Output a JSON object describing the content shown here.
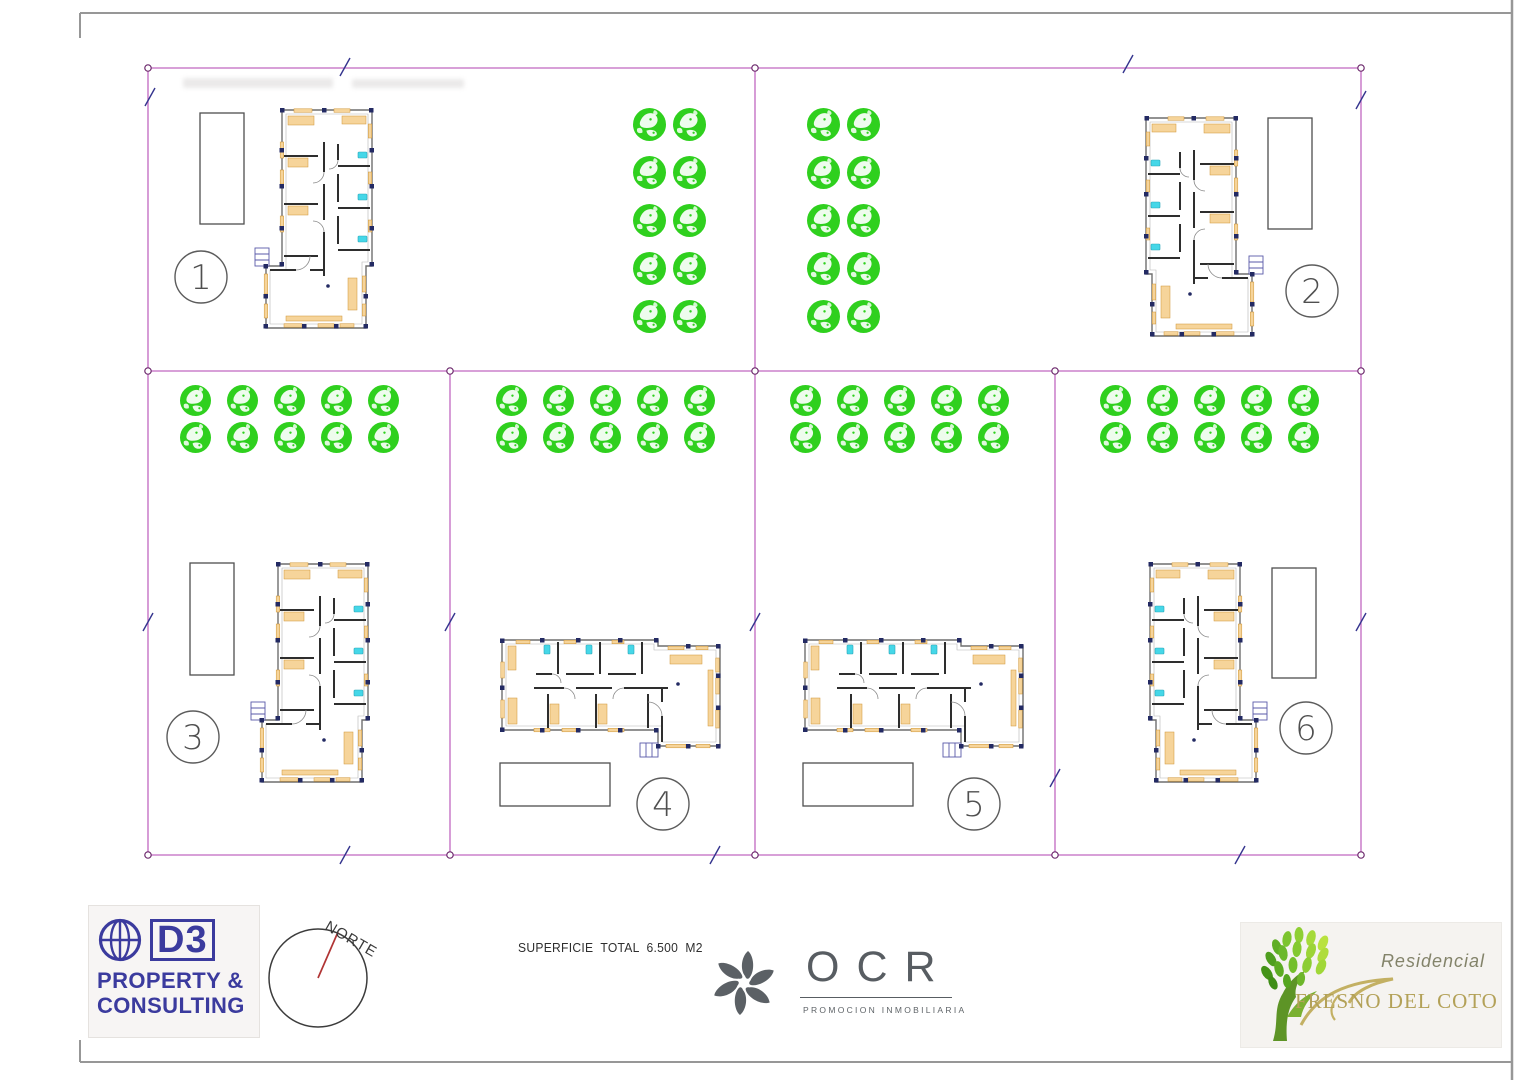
{
  "site": {
    "colors": {
      "boundary": "#c168c1",
      "tick": "#34348e",
      "marker": "#6d2a6d",
      "tree": "#2fd01e"
    },
    "boundary_lines": [
      [
        148,
        68,
        1361,
        68
      ],
      [
        1361,
        68,
        1361,
        855
      ],
      [
        148,
        855,
        1361,
        855
      ],
      [
        148,
        68,
        148,
        855
      ],
      [
        755,
        68,
        755,
        371
      ],
      [
        148,
        371,
        1361,
        371
      ],
      [
        450,
        371,
        450,
        855
      ],
      [
        755,
        371,
        755,
        855
      ],
      [
        1055,
        371,
        1055,
        855
      ]
    ],
    "ticks": [
      [
        345,
        67
      ],
      [
        1128,
        64
      ],
      [
        150,
        97
      ],
      [
        1361,
        100
      ],
      [
        148,
        622
      ],
      [
        450,
        622
      ],
      [
        755,
        622
      ],
      [
        1361,
        622
      ],
      [
        345,
        855
      ],
      [
        715,
        855
      ],
      [
        1240,
        855
      ],
      [
        1055,
        778
      ]
    ],
    "markers": [
      [
        148,
        68
      ],
      [
        755,
        68
      ],
      [
        1361,
        68
      ],
      [
        148,
        371
      ],
      [
        450,
        371
      ],
      [
        755,
        371
      ],
      [
        1055,
        371
      ],
      [
        1361,
        371
      ],
      [
        148,
        855
      ],
      [
        450,
        855
      ],
      [
        755,
        855
      ],
      [
        1055,
        855
      ],
      [
        1361,
        855
      ]
    ],
    "plots": [
      {
        "number": "1",
        "circle": [
          201,
          277,
          26
        ],
        "pool": [
          200,
          113,
          44,
          111
        ],
        "house": "translate(262,108)",
        "trees": {
          "x": 633,
          "y": 108,
          "cols": 2,
          "rows": 5,
          "px": 40,
          "py": 48,
          "d": 33
        }
      },
      {
        "number": "2",
        "circle": [
          1312,
          291,
          26
        ],
        "pool": [
          1268,
          118,
          44,
          111
        ],
        "house": "translate(1256,116) scale(-1,1)",
        "trees": {
          "x": 807,
          "y": 108,
          "cols": 2,
          "rows": 5,
          "px": 40,
          "py": 48,
          "d": 33
        }
      },
      {
        "number": "3",
        "circle": [
          193,
          737,
          26
        ],
        "pool": [
          190,
          563,
          44,
          112
        ],
        "house": "translate(258,562)",
        "trees": {
          "x": 180,
          "y": 385,
          "cols": 5,
          "rows": 2,
          "px": 47,
          "py": 37,
          "d": 31
        }
      },
      {
        "number": "4",
        "circle": [
          663,
          804,
          26
        ],
        "pool": [
          500,
          763,
          110,
          43
        ],
        "house": "translate(500,750) rotate(-90)",
        "trees": {
          "x": 496,
          "y": 385,
          "cols": 5,
          "rows": 2,
          "px": 47,
          "py": 37,
          "d": 31
        }
      },
      {
        "number": "5",
        "circle": [
          974,
          804,
          26
        ],
        "pool": [
          803,
          763,
          110,
          43
        ],
        "house": "translate(803,750) rotate(-90)",
        "trees": {
          "x": 790,
          "y": 385,
          "cols": 5,
          "rows": 2,
          "px": 47,
          "py": 37,
          "d": 31
        }
      },
      {
        "number": "6",
        "circle": [
          1306,
          728,
          26
        ],
        "pool": [
          1272,
          568,
          44,
          110
        ],
        "house": "translate(1260,562) scale(-1,1)",
        "trees": {
          "x": 1100,
          "y": 385,
          "cols": 5,
          "rows": 2,
          "px": 47,
          "py": 37,
          "d": 31
        }
      }
    ]
  },
  "footer": {
    "d3_logo": {
      "monogram": "D3",
      "line1": "PROPERTY &",
      "line2": "CONSULTING"
    },
    "compass_label": "NORTE",
    "surface_note": "SUPERFICIE  TOTAL  6.500  M2",
    "ocr": {
      "name": "OCR",
      "subtitle": "PROMOCION INMOBILIARIA"
    },
    "fresno": {
      "line1": "Residencial",
      "line2": "FRESNO DEL COTO"
    }
  }
}
